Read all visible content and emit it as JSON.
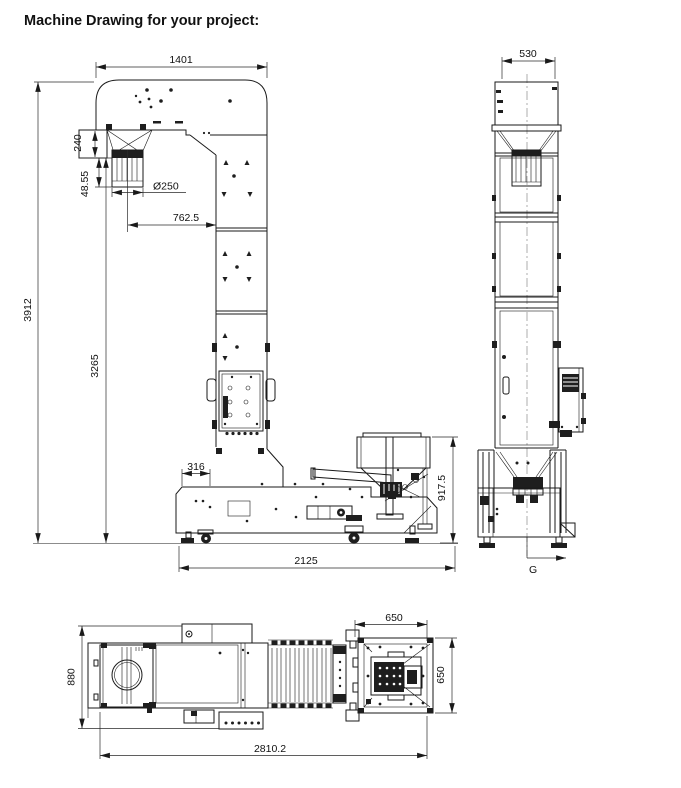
{
  "title": "Machine Drawing for your project:",
  "colors": {
    "line": "#1a1a1a",
    "background": "#ffffff"
  },
  "views": {
    "front": {
      "name": "front elevation",
      "dims": {
        "head_width": "1401",
        "hopper_box_height": "240",
        "outlet_neck_height": "48.55",
        "outlet_diameter": "Ø250",
        "outlet_to_column": "762.5",
        "overall_height": "3912",
        "column_height": "3265",
        "base_left_offset": "316",
        "infeed_height": "917.5",
        "base_length": "2125"
      }
    },
    "side": {
      "name": "side elevation",
      "dims": {
        "column_width": "530"
      },
      "marker": "G"
    },
    "top": {
      "name": "top plan",
      "dims": {
        "discharge_box_width": "650",
        "discharge_box_depth": "650",
        "body_width": "880",
        "overall_length": "2810.2"
      }
    }
  }
}
